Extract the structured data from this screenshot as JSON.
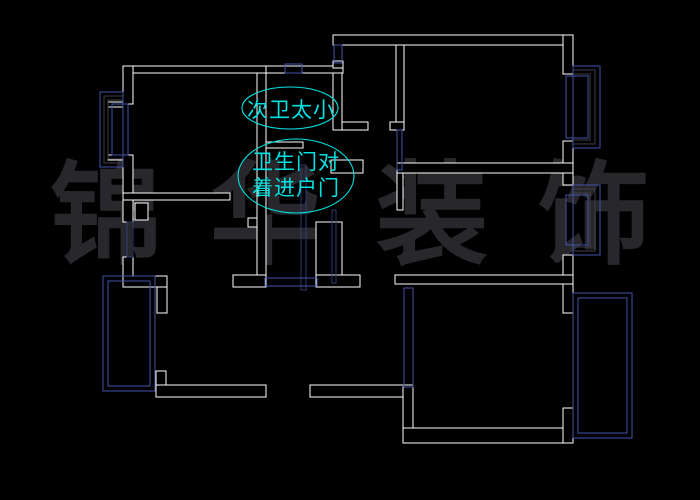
{
  "canvas": {
    "width": 700,
    "height": 500,
    "background": "#000000"
  },
  "watermark": {
    "text": "锦华装饰",
    "chars": [
      "锦",
      "华",
      "装",
      "饰"
    ],
    "color": "#28282c"
  },
  "annotations": [
    {
      "id": "secondary-bathroom-too-small",
      "lines": [
        "次卫太小"
      ],
      "color": "#00e2e2",
      "ellipse": {
        "cx": 290,
        "cy": 108,
        "rx": 48,
        "ry": 21
      }
    },
    {
      "id": "bathroom-door-faces-entry-door",
      "lines": [
        "卫生门对",
        "着进户门"
      ],
      "color": "#00e2e2",
      "ellipse": {
        "cx": 296,
        "cy": 176,
        "rx": 58,
        "ry": 37
      }
    }
  ],
  "floorplan": {
    "wall_color": "#ffffff",
    "window_color": "#4254a8",
    "window_color_dark": "#2e3a72",
    "frame_gray": "#3f3f44",
    "walls": [
      [
        123,
        66,
        143,
        7
      ],
      [
        266,
        66,
        77,
        7
      ],
      [
        123,
        66,
        10,
        38
      ],
      [
        108,
        102,
        15,
        5
      ],
      [
        108,
        155,
        15,
        5
      ],
      [
        123,
        155,
        10,
        47
      ],
      [
        123,
        193,
        107,
        7
      ],
      [
        257,
        73,
        9,
        204
      ],
      [
        248,
        218,
        9,
        9
      ],
      [
        233,
        275,
        33,
        12
      ],
      [
        266,
        142,
        37,
        6
      ],
      [
        333,
        73,
        9,
        57
      ],
      [
        342,
        122,
        26,
        8
      ],
      [
        333,
        35,
        240,
        10
      ],
      [
        333,
        61,
        10,
        7
      ],
      [
        396,
        45,
        8,
        77
      ],
      [
        390,
        122,
        14,
        8
      ],
      [
        563,
        35,
        10,
        39
      ],
      [
        563,
        141,
        10,
        44
      ],
      [
        331,
        160,
        32,
        13
      ],
      [
        397,
        163,
        176,
        10
      ],
      [
        397,
        173,
        6,
        37
      ],
      [
        316,
        222,
        26,
        57
      ],
      [
        316,
        275,
        44,
        12
      ],
      [
        123,
        200,
        10,
        22
      ],
      [
        123,
        257,
        10,
        19
      ],
      [
        123,
        276,
        44,
        11
      ],
      [
        157,
        287,
        10,
        26
      ],
      [
        135,
        203,
        13,
        17
      ],
      [
        156,
        371,
        10,
        14
      ],
      [
        156,
        385,
        110,
        12
      ],
      [
        310,
        385,
        103,
        12
      ],
      [
        395,
        275,
        178,
        9
      ],
      [
        403,
        387,
        10,
        56
      ],
      [
        403,
        428,
        170,
        15
      ],
      [
        563,
        284,
        10,
        29
      ],
      [
        563,
        408,
        10,
        35
      ],
      [
        563,
        255,
        10,
        20
      ]
    ],
    "frame_rects": [
      [
        573,
        70,
        22,
        74
      ],
      [
        573,
        74,
        17,
        66
      ],
      [
        573,
        189,
        22,
        62
      ],
      [
        573,
        193,
        17,
        54
      ],
      [
        104,
        96,
        19,
        67
      ],
      [
        108,
        100,
        15,
        59
      ]
    ],
    "window_rects": [
      {
        "x": 103,
        "y": 276,
        "w": 52,
        "h": 115
      },
      {
        "x": 108,
        "y": 281,
        "w": 42,
        "h": 105
      },
      {
        "x": 573,
        "y": 293,
        "w": 59,
        "h": 145
      },
      {
        "x": 578,
        "y": 298,
        "w": 49,
        "h": 135
      },
      {
        "x": 573,
        "y": 66,
        "w": 27,
        "h": 82
      },
      {
        "x": 566,
        "y": 76,
        "w": 22,
        "h": 62
      },
      {
        "x": 573,
        "y": 185,
        "w": 27,
        "h": 70
      },
      {
        "x": 566,
        "y": 195,
        "w": 22,
        "h": 50
      },
      {
        "x": 100,
        "y": 92,
        "w": 23,
        "h": 75
      },
      {
        "x": 112,
        "y": 104,
        "w": 16,
        "h": 51
      },
      {
        "x": 285,
        "y": 64,
        "w": 17,
        "h": 9
      },
      {
        "x": 334,
        "y": 45,
        "w": 8,
        "h": 18
      },
      {
        "x": 397,
        "y": 130,
        "w": 5,
        "h": 40
      },
      {
        "x": 301,
        "y": 165,
        "w": 5,
        "h": 125,
        "dark": true
      },
      {
        "x": 332,
        "y": 210,
        "w": 4,
        "h": 73,
        "dark": true
      },
      {
        "x": 265,
        "y": 278,
        "w": 52,
        "h": 8
      },
      {
        "x": 404,
        "y": 288,
        "w": 9,
        "h": 99
      },
      {
        "x": 127,
        "y": 222,
        "w": 6,
        "h": 35,
        "dark": true
      }
    ]
  }
}
